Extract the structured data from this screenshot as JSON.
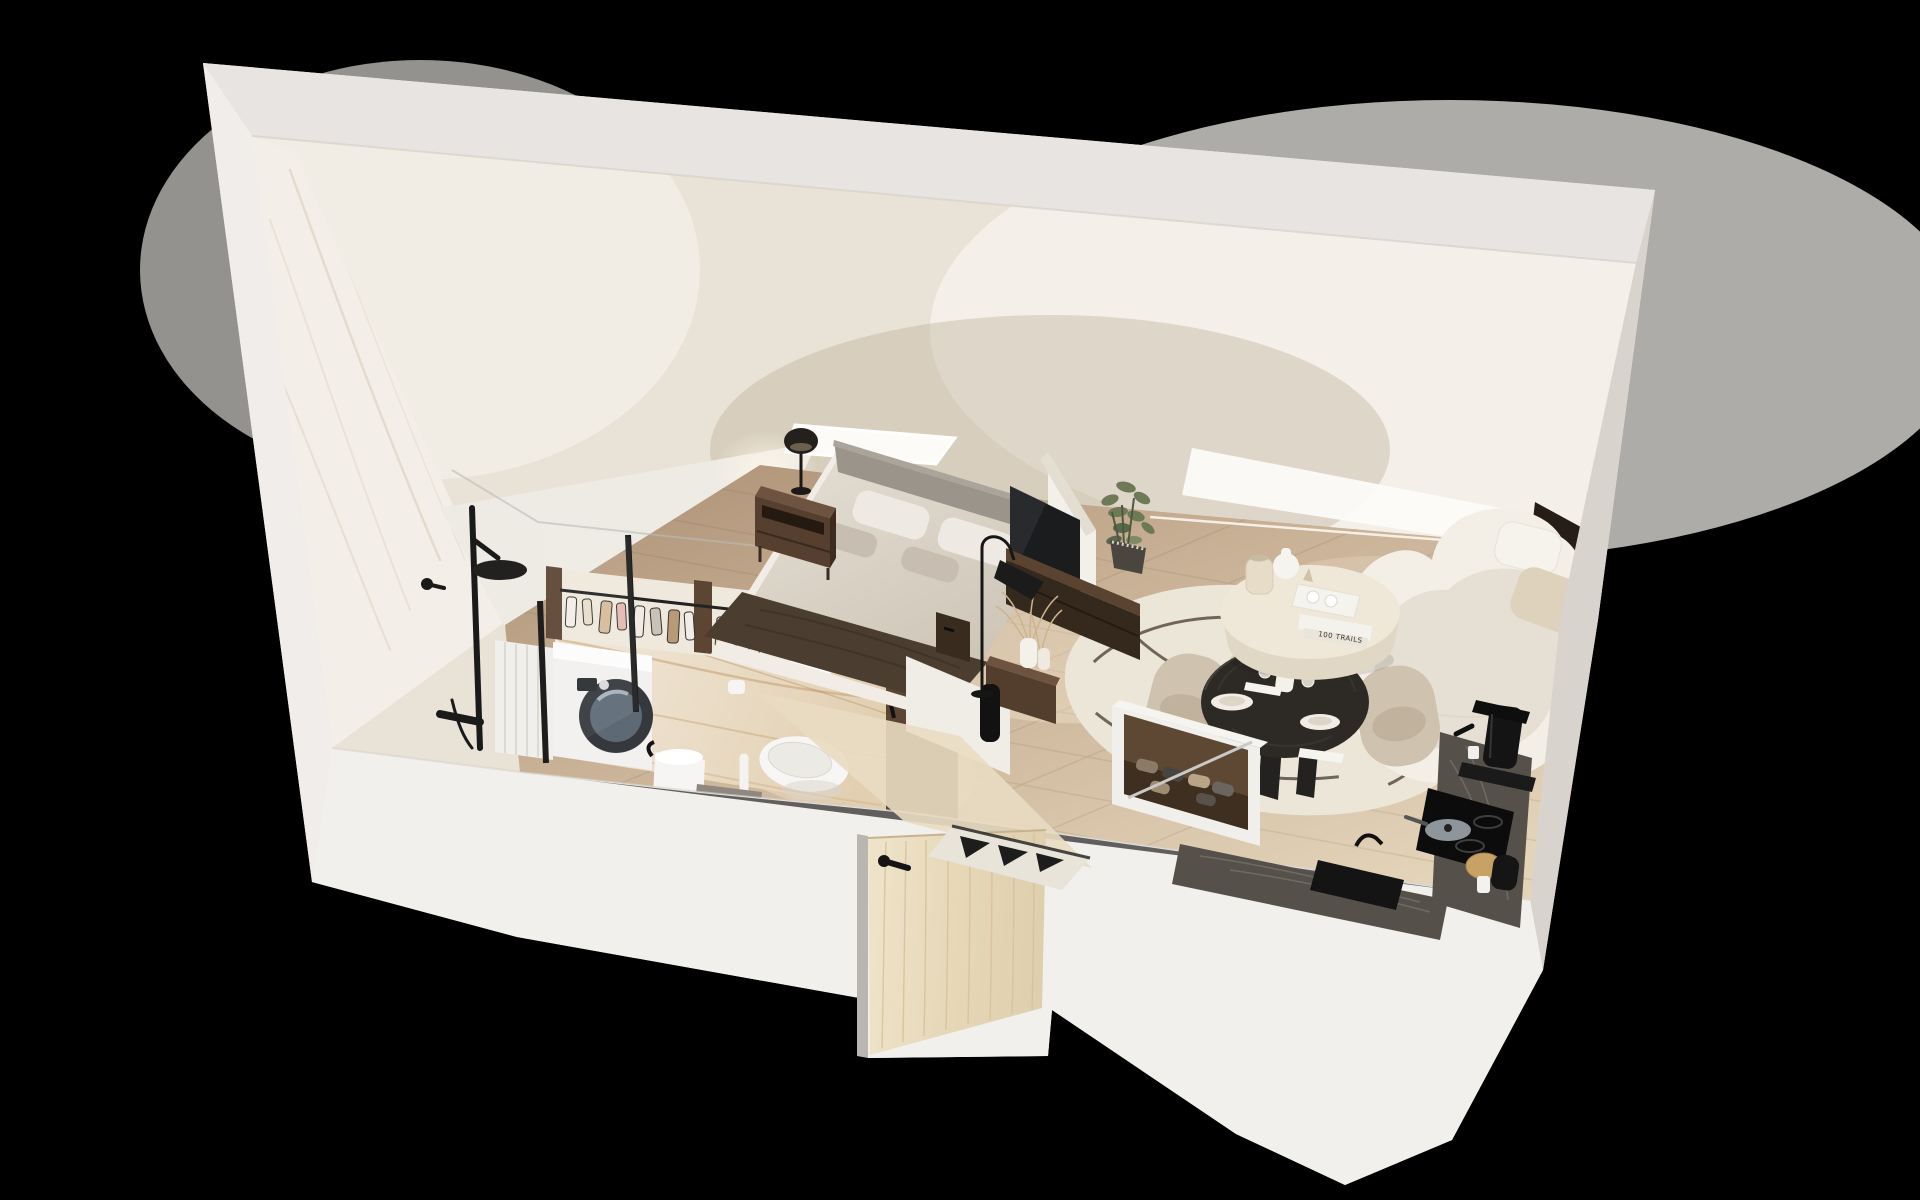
{
  "image": {
    "title": "3D cutaway render of an attic studio apartment",
    "style": "isometric dollhouse section view on black background"
  },
  "book_spine_text": "100 TRAILS",
  "scene": {
    "rooms": [
      "bathroom",
      "wardrobe",
      "bedroom",
      "entry",
      "living-dining",
      "kitchen"
    ],
    "objects": [
      "shower-set",
      "glass-partition",
      "washing-machine",
      "laundry-hamper",
      "toilet",
      "flush-plate",
      "toilet-paper-holder",
      "wash-basin",
      "clothes-rail",
      "hanging-clothes",
      "bed",
      "headboard",
      "pillows",
      "throw-blanket",
      "nightstand",
      "table-lamp",
      "tv",
      "media-bench",
      "floor-lamp",
      "dried-pampas-vases",
      "black-cylinder-vase",
      "potted-plant",
      "skylight",
      "round-rug",
      "coffee-table",
      "stacked-books",
      "dining-table",
      "dining-chairs",
      "plates",
      "wine-glasses",
      "curved-sofa",
      "sofa-cushions",
      "shoe-storage-box",
      "kitchen-counter",
      "induction-cooktop",
      "frying-pan",
      "coffee-machine",
      "kettle",
      "mug",
      "kitchen-sink",
      "entry-door",
      "door-handle",
      "doormat",
      "herringbone-floor"
    ]
  },
  "colors": {
    "background": "#000000",
    "slab_base": "#e9e5e1",
    "slab_top": "#e8e4e1",
    "slab_left": "#f0edea",
    "slab_right": "#d9d3cd",
    "slab_front": "#f2f0ed",
    "ceiling": "#e9e2d6",
    "skylight": "#fcfbf8",
    "marble_wall": "#f3efe8",
    "marble_vein": "#d8cdbb",
    "bath_marble": "#eadbc6",
    "bath_vein": "#c29a6b",
    "floor": "#c7ae92",
    "entry_floor": "#e9dcc2",
    "rug": "#ece6d9",
    "rug_pattern": "#4a3a2c",
    "bed_duvet": "#d9d2c7",
    "bed_platform": "#f1ede6",
    "bed_throw": "#4b3e30",
    "headboard": "#9b948a",
    "pillow_white": "#eee9e2",
    "pillow_gray": "#c7beb1",
    "walnut": "#5d4533",
    "walnut_dark": "#3a2b1f",
    "walnut_light": "#74573f",
    "fixture_black": "#1a1a1a",
    "tv_screen": "#1b1c1e",
    "sofa": "#f3efe7",
    "sofa_shadow": "#d9d2c4",
    "chair": "#cfc3b0",
    "dining_table": "#2d2a26",
    "coffee_table": "#efe8d9",
    "counter": "#55504a",
    "door_wood": "#ecdfc3",
    "mat_dark": "#1d1d1d",
    "plant": "#6d7a55",
    "shadow_wall": "#261e16",
    "white_goods": "#f2f1ef"
  }
}
